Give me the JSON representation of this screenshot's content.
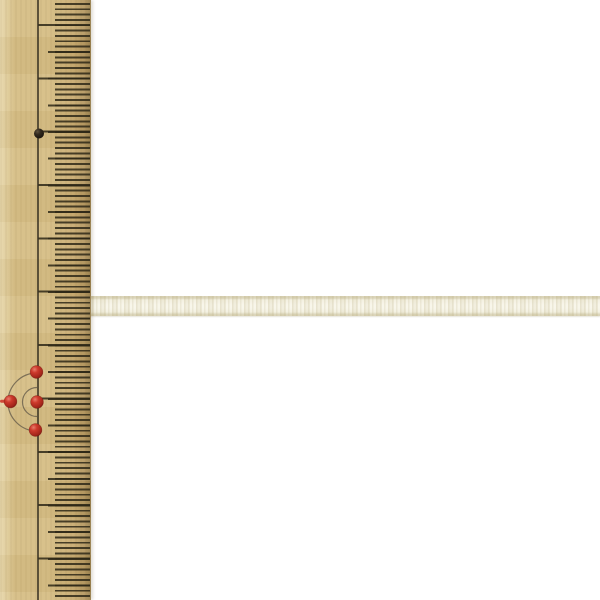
{
  "scene": {
    "width": 600,
    "height": 600,
    "subject": "Cream satin craft ribbon laid horizontally against a vertical wooden ruler with pins, on a white background",
    "background_color": "#ffffff"
  },
  "palette": {
    "bg": "#ffffff",
    "wood": "#d6be85",
    "wood_light": "#e8d8ac",
    "wood_dark": "#c9ac72",
    "wood_edge": "#98804f",
    "tick": "#2e2817d9",
    "line": "#3a3324",
    "arc": "#6c624d",
    "ribbon": "#f2efde",
    "ribbon_hi": "#f7f5e8",
    "ribbon_edge": "#d7d0b2",
    "pin_red": "#cd3a2c",
    "pin_black": "#2b241b"
  },
  "ruler": {
    "orientation": "vertical",
    "width_px": 91,
    "center_line": {
      "x": 37,
      "width": 1.5
    },
    "ticks": [
      {
        "name": "fine",
        "x": 55,
        "length": 35,
        "first_y": 3.66,
        "spacing": 5.335,
        "thickness": 1.9
      },
      {
        "name": "medium",
        "x": 48,
        "length": 42,
        "first_y": 51.68,
        "spacing": 26.675,
        "thickness": 2
      },
      {
        "name": "long",
        "x": 38,
        "length": 52,
        "first_y": 25,
        "spacing": 53.35,
        "thickness": 2
      }
    ],
    "black_pin": {
      "cx": 39,
      "cy": 133.5,
      "r": 5
    },
    "red_pins": [
      {
        "cx": 36.5,
        "cy": 372,
        "r": 6.4
      },
      {
        "cx": 37,
        "cy": 402,
        "r": 6.4
      },
      {
        "cx": 35.5,
        "cy": 430,
        "r": 6.4
      },
      {
        "cx": 10.5,
        "cy": 401.5,
        "r": 6.4
      }
    ],
    "arcs": [
      {
        "cx": 37,
        "cy": 402,
        "r": 29
      },
      {
        "cx": 37,
        "cy": 402,
        "r": 14.5
      }
    ],
    "red_edge_dash": {
      "x": 0,
      "y": 399.8,
      "w": 6,
      "h": 3
    }
  },
  "ribbon": {
    "x": 88,
    "y": 296,
    "height_px": 20,
    "reaches_right_edge": true
  }
}
